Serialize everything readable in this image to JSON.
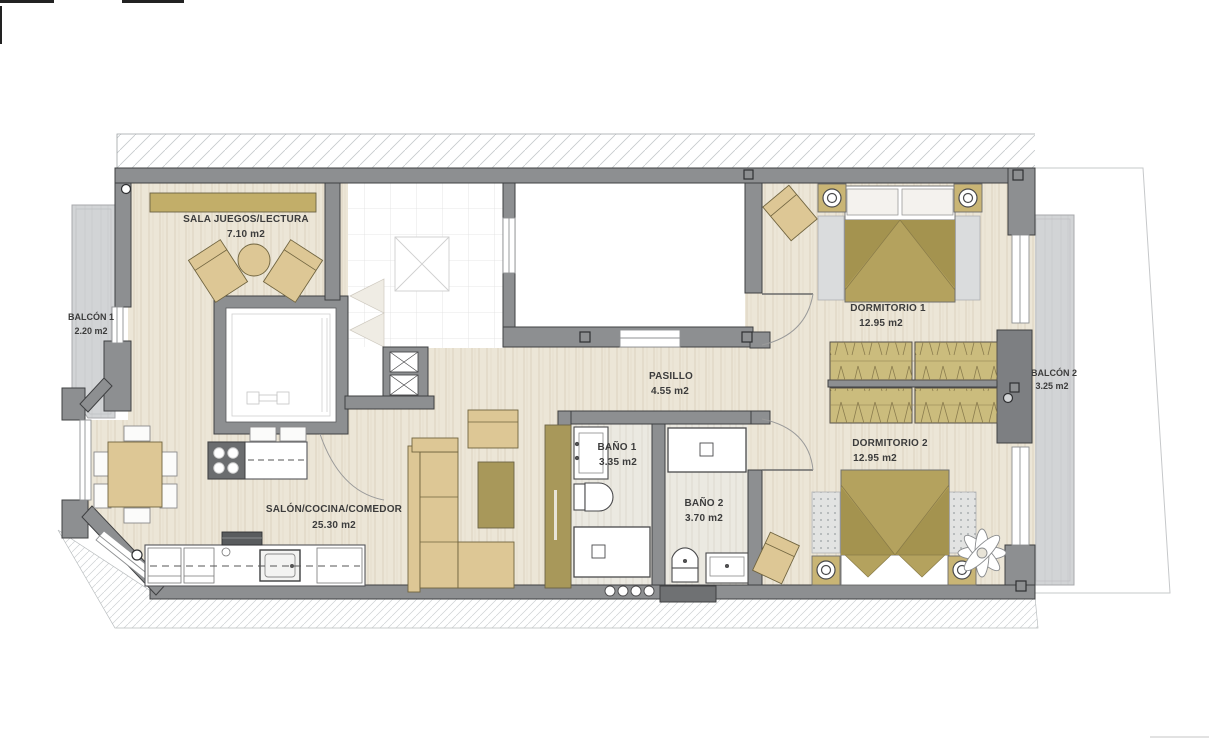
{
  "rooms": {
    "sala": {
      "name": "SALA JUEGOS/LECTURA",
      "area": "7.10 m2"
    },
    "balcon1": {
      "name": "BALCÓN 1",
      "area": "2.20 m2"
    },
    "salon": {
      "name": "SALÓN/COCINA/COMEDOR",
      "area": "25.30 m2"
    },
    "pasillo": {
      "name": "PASILLO",
      "area": "4.55 m2"
    },
    "bano1": {
      "name": "BAÑO 1",
      "area": "3.35 m2"
    },
    "bano2": {
      "name": "BAÑO 2",
      "area": "3.70 m2"
    },
    "dorm1": {
      "name": "DORMITORIO 1",
      "area": "12.95 m2"
    },
    "dorm2": {
      "name": "DORMITORIO 2",
      "area": "12.95 m2"
    },
    "balcon2": {
      "name": "BALCÓN 2",
      "area": "3.25 m2"
    }
  },
  "colors": {
    "wall": "#8d8f91",
    "wall_outline": "#3f4042",
    "wood_floor": "#ece6d7",
    "furniture_tan": "#ddc795",
    "furniture_dark_tan": "#a8985a",
    "bed_tan": "#b4a25e",
    "wardrobe_tan": "#cbbc7d",
    "balcony_gray": "#d2d4d6",
    "label_text": "#3c3c3c"
  }
}
